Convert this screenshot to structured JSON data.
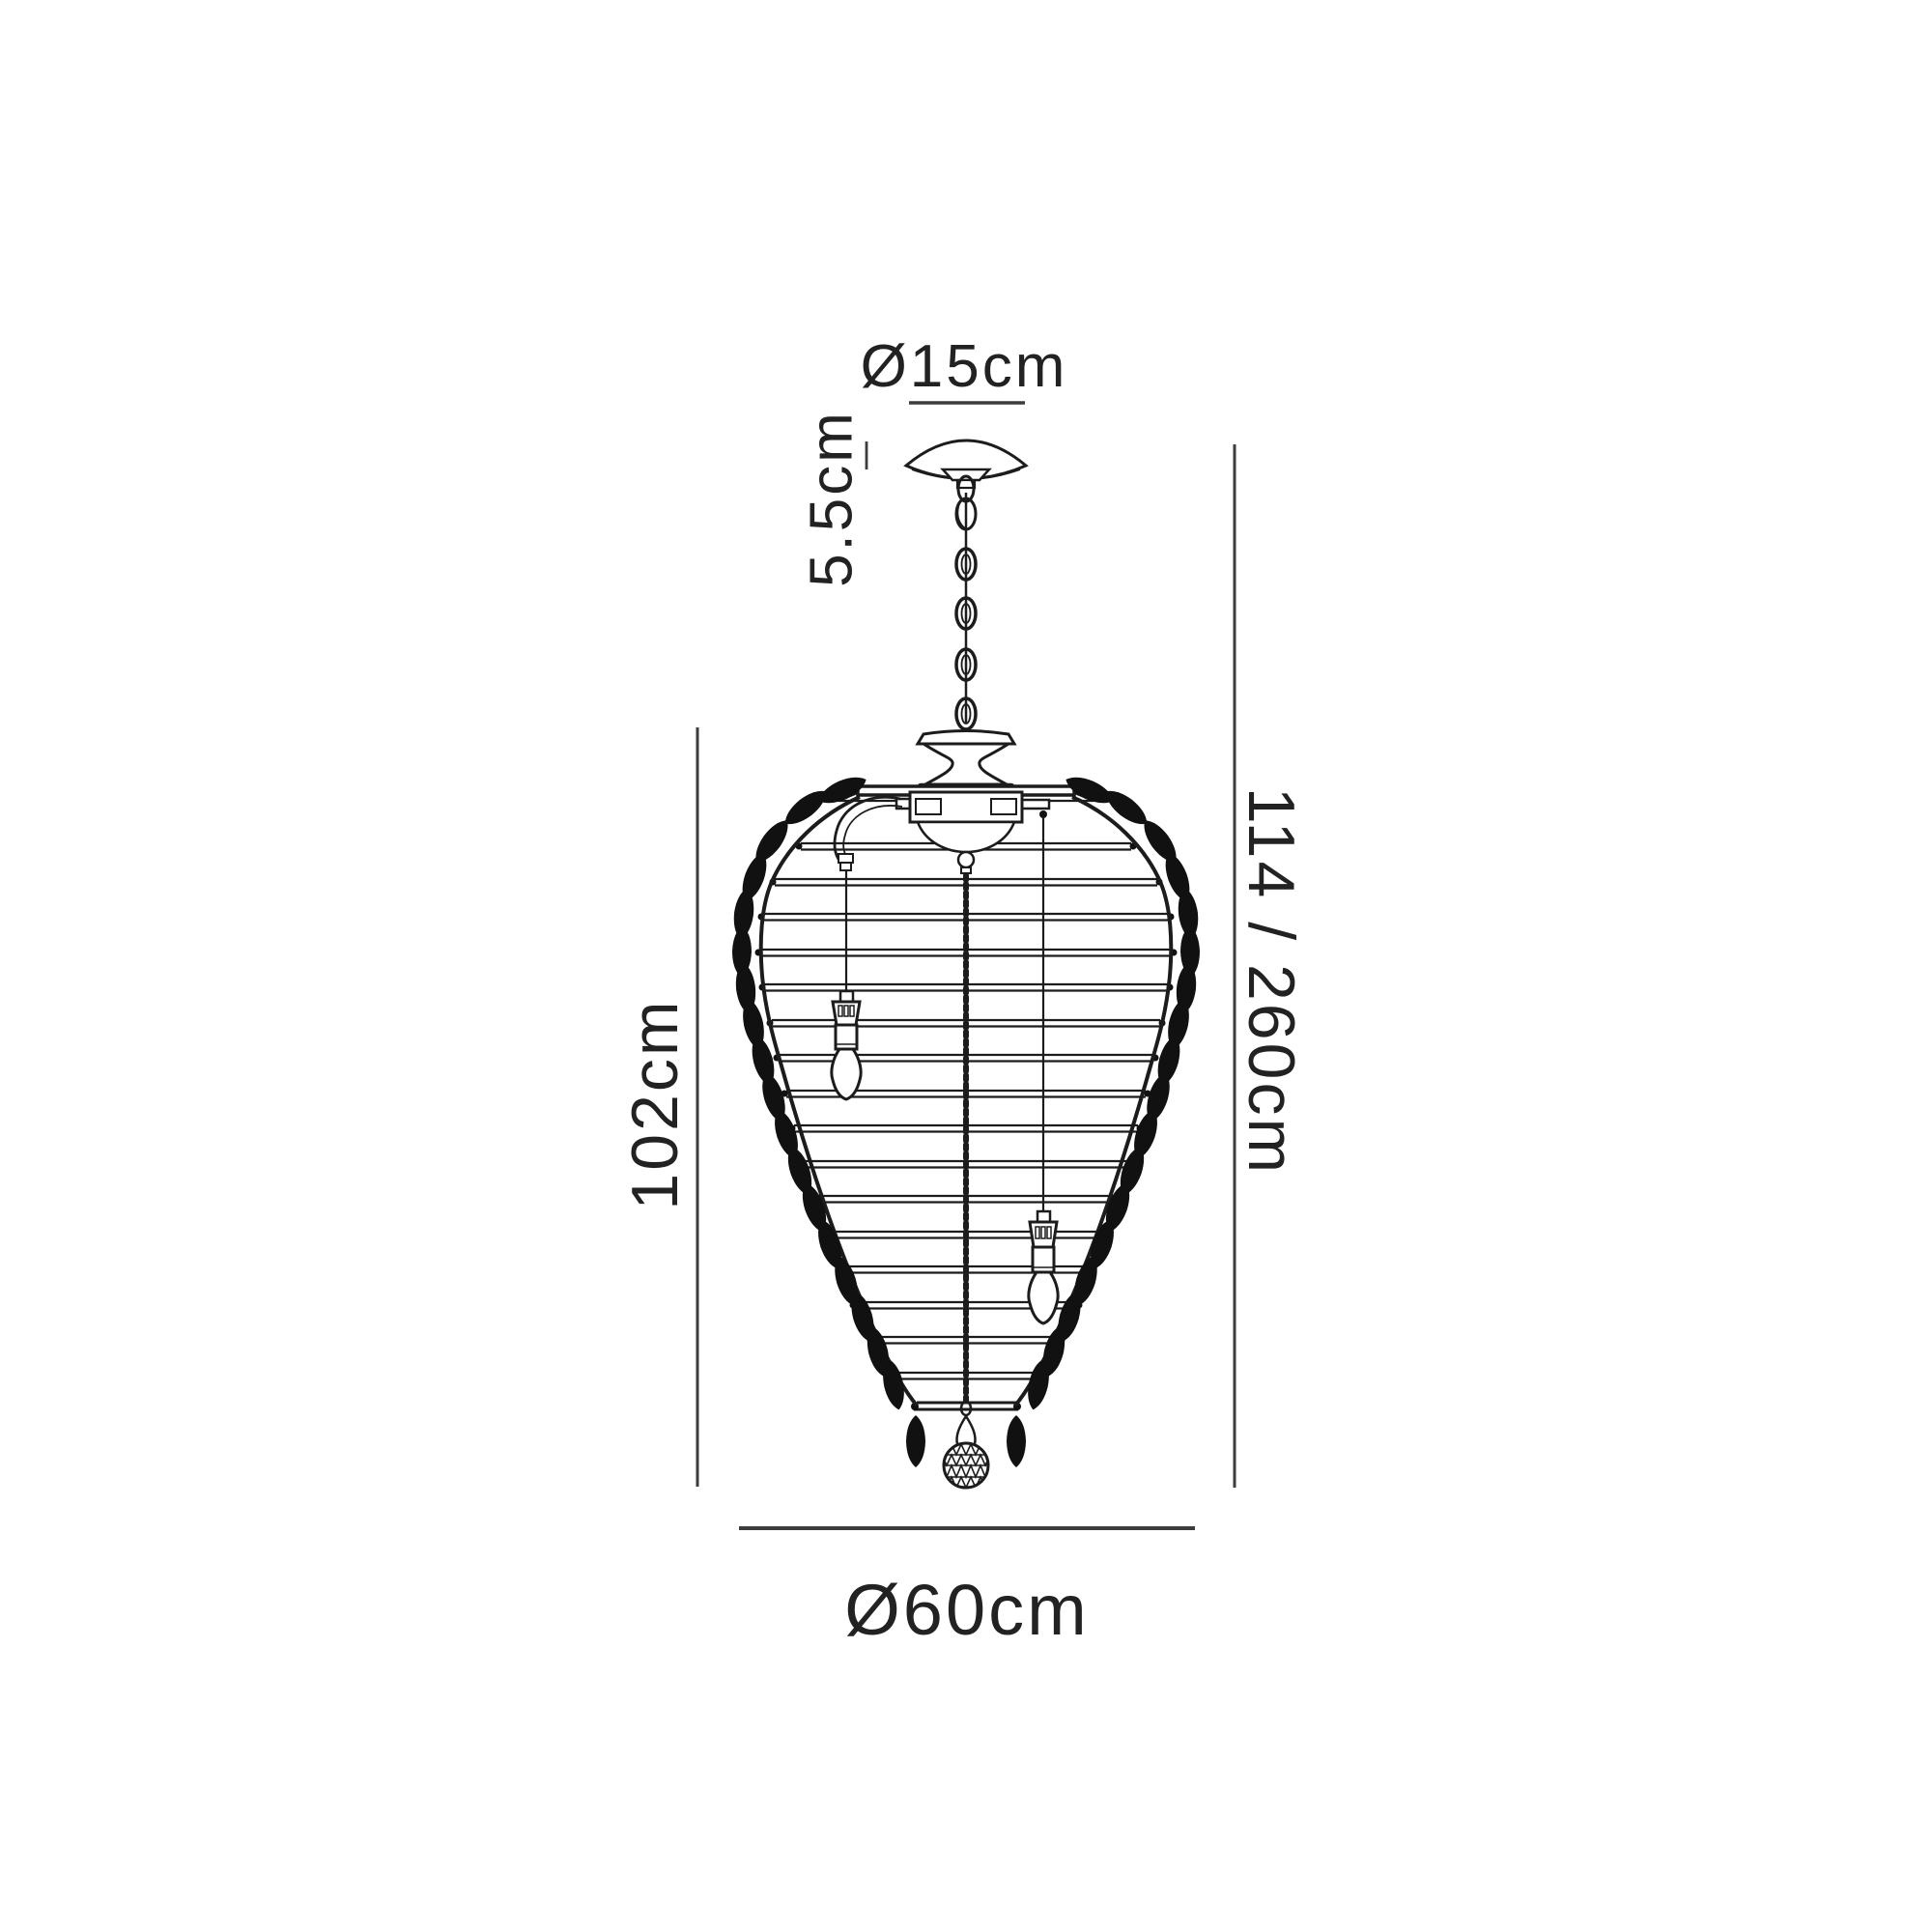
{
  "page": {
    "title": "Pendant chandelier dimension diagram",
    "background": "#ffffff"
  },
  "labels": {
    "canopy_diameter": "Ø15cm",
    "canopy_height": "5.5cm",
    "overall_height": "114 / 260cm",
    "body_height": "102cm",
    "body_diameter": "Ø60cm"
  },
  "colors": {
    "line": "#1c1c1c",
    "dimension": "#3c3c3c",
    "text": "#222222"
  }
}
